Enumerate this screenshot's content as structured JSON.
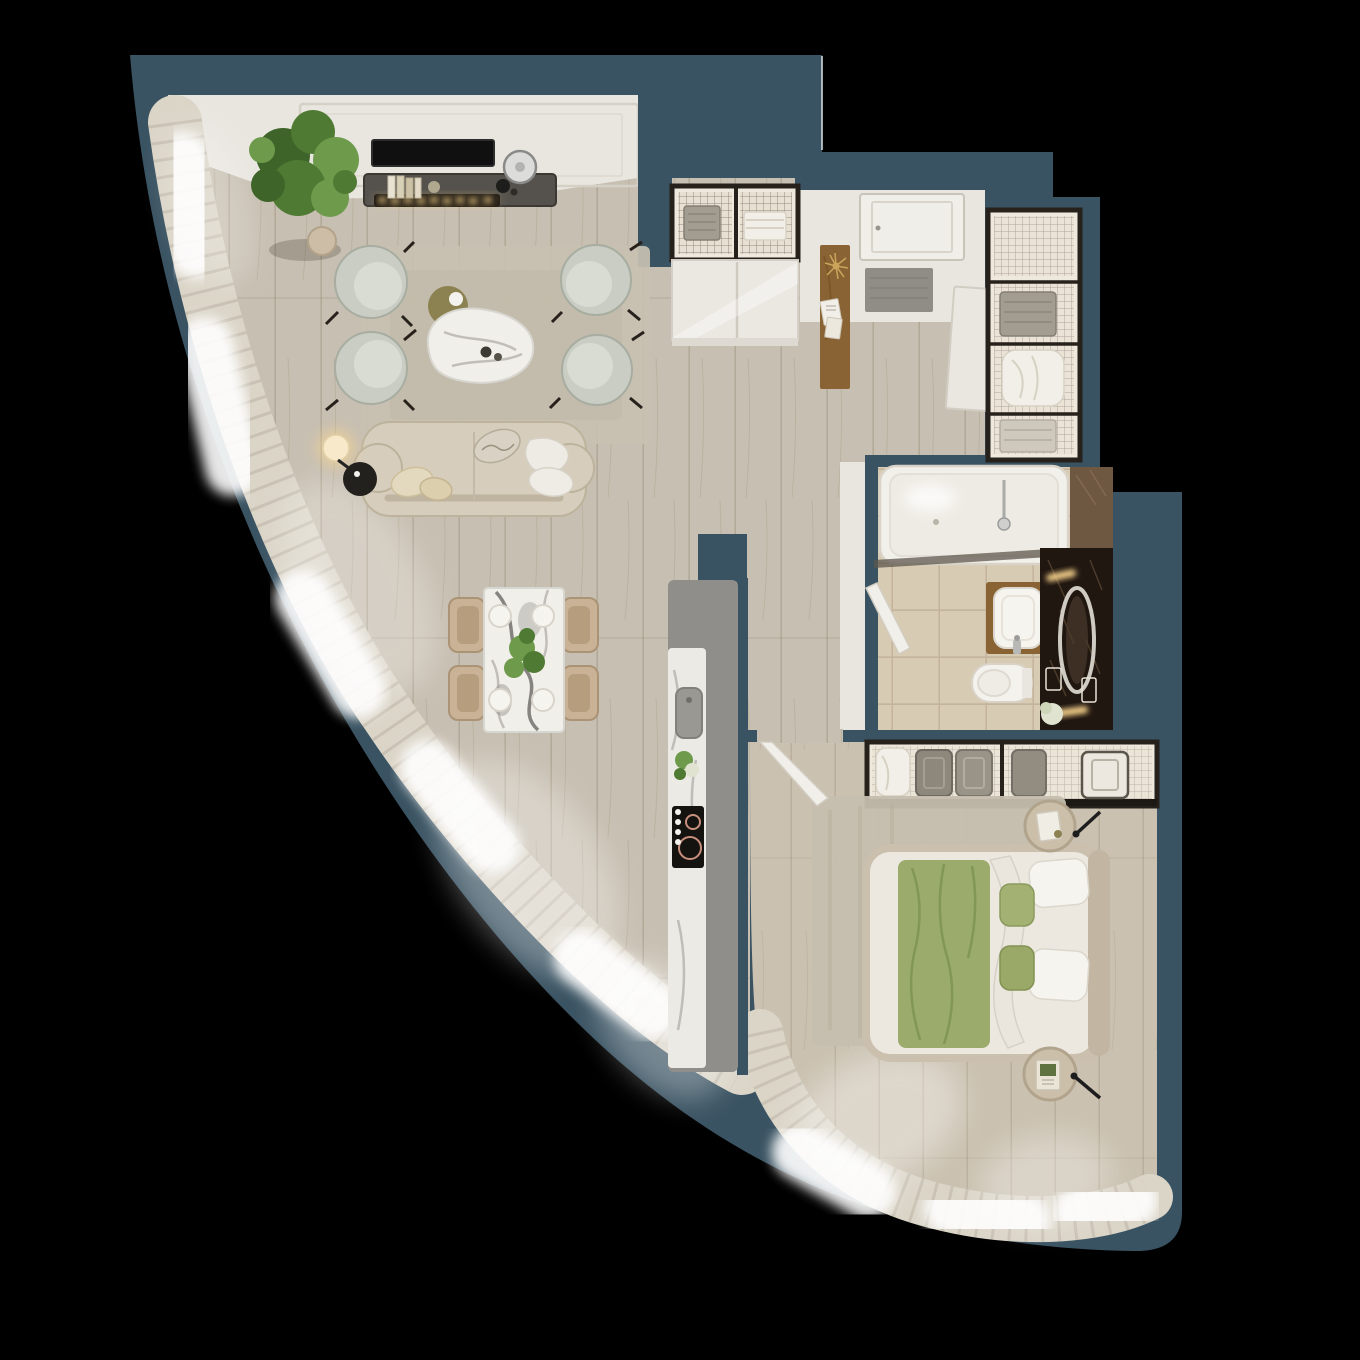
{
  "scene": {
    "type": "3d-apartment-floor-plan-top-view",
    "style": "photoreal render, curved window facade, no text labels",
    "canvas": {
      "width": 1360,
      "height": 1360
    }
  },
  "colors": {
    "bg": "#000000",
    "wall": "#3a5362",
    "wallEdge": "#cfd8dc",
    "floor": "#c7bfb1",
    "floorSeam": "#9a8d79",
    "bedFloor": "#cac1b0",
    "ceiling": "#e9e6e0",
    "molding": "#d5d0c6",
    "panel": "#e9e6e0",
    "tile": "#d8cbb3",
    "tileLine": "#c3b49b",
    "curtain": "#dbd5c8",
    "curtainShadow": "#b9b1a2",
    "rug": "#c8c1b2",
    "rugBed": "#c5beae",
    "sofa": "#d6cdbc",
    "sofaLine": "#bdb29c",
    "chair": "#c9cdc4",
    "chairLine": "#a8ada1",
    "chairInner": "#d8dcd3",
    "marble": "#f1efe9",
    "marbleEdge": "#d8d6d0",
    "vein": "#b0aeaa",
    "veinDark": "#6a6965",
    "olive": "#8c8150",
    "island": "#8f8e8a",
    "islandMarble": "#eceae5",
    "cooktop": "#151310",
    "burner": "#c98f7d",
    "woodBrown": "#8a6334",
    "mat": "#8f8d85",
    "frame": "#26211b",
    "closetBg": "#efe9dd",
    "towel": "#a39d91",
    "towelLine": "#857f73",
    "linen": "#f2efe8",
    "linenLine": "#d7d1c4",
    "white": "#f4f2ee",
    "doorWhite": "#f0eee9",
    "doorEdge": "#c9c4ba",
    "tub": "#f2f0eb",
    "tubEdge": "#d9d3c8",
    "darkMarble": "#211711",
    "midMarble": "#6e5842",
    "mirror": "#cfcac2",
    "glow": "#ffd98f",
    "green": "#4f7a33",
    "green2": "#6d9a4b",
    "green3": "#3f6429",
    "blanket": "#9aab6b",
    "blanketDark": "#7c9150",
    "mattress": "#ece8e0",
    "bedframe": "#cbc0ae",
    "tan": "#cbbfa9",
    "pillowW": "#f6f4ef",
    "pillowWEdge": "#dcd7cc",
    "metal": "#b9b9b7"
  },
  "rooms": [
    {
      "id": "living-room",
      "furniture": [
        "media-console",
        "tv-screen",
        "bio-fireplace",
        "books",
        "decor-disc",
        "potted-plant",
        "area-rug",
        "armchair x4",
        "coffee-table",
        "olive-side-disc",
        "sofa",
        "sofa-pillows",
        "floor-lamp",
        "black-side-table"
      ]
    },
    {
      "id": "dining-area",
      "furniture": [
        "marble-dining-table",
        "dining-chair x4",
        "plate x4",
        "centerpiece-plant"
      ]
    },
    {
      "id": "kitchen",
      "furniture": [
        "island-counter",
        "marble-worktop",
        "sink",
        "cooktop-2-burners",
        "control-knobs",
        "flowers"
      ]
    },
    {
      "id": "entry-hall",
      "furniture": [
        "entrance-door",
        "doormat",
        "wood-console",
        "sputnik-chandelier",
        "papers",
        "mesh-storage-cabinet",
        "sliding-wardrobe",
        "white-panel"
      ]
    },
    {
      "id": "walk-in-closet",
      "furniture": [
        "metal-frame-shelving",
        "towel-stack",
        "duvet",
        "folded-linens"
      ]
    },
    {
      "id": "bathroom",
      "furniture": [
        "bathtub-shower",
        "glass-screen",
        "shower-head",
        "wood-vanity",
        "basin-sink",
        "faucet",
        "toilet",
        "dark-marble-wall",
        "oval-mirror",
        "sconce-light x2",
        "perfume-bottles",
        "flowers",
        "door-leaf"
      ]
    },
    {
      "id": "bedroom",
      "furniture": [
        "mesh-wardrobe",
        "basket-pillows",
        "area-rug",
        "double-bed",
        "green-velvet-blanket",
        "white-duvet",
        "pillow x4",
        "round-nightstand x2",
        "wall-lamp x2",
        "curtains",
        "door-leaf"
      ]
    }
  ],
  "architecture": {
    "outer_wall": "stepped on north/east, sweeping concave curve on west/south",
    "window_wall": "floor-to-ceiling glazing with sheer curtains along the full curve",
    "openings": [
      "entrance-door-north",
      "bedroom-door",
      "bathroom-door"
    ]
  }
}
